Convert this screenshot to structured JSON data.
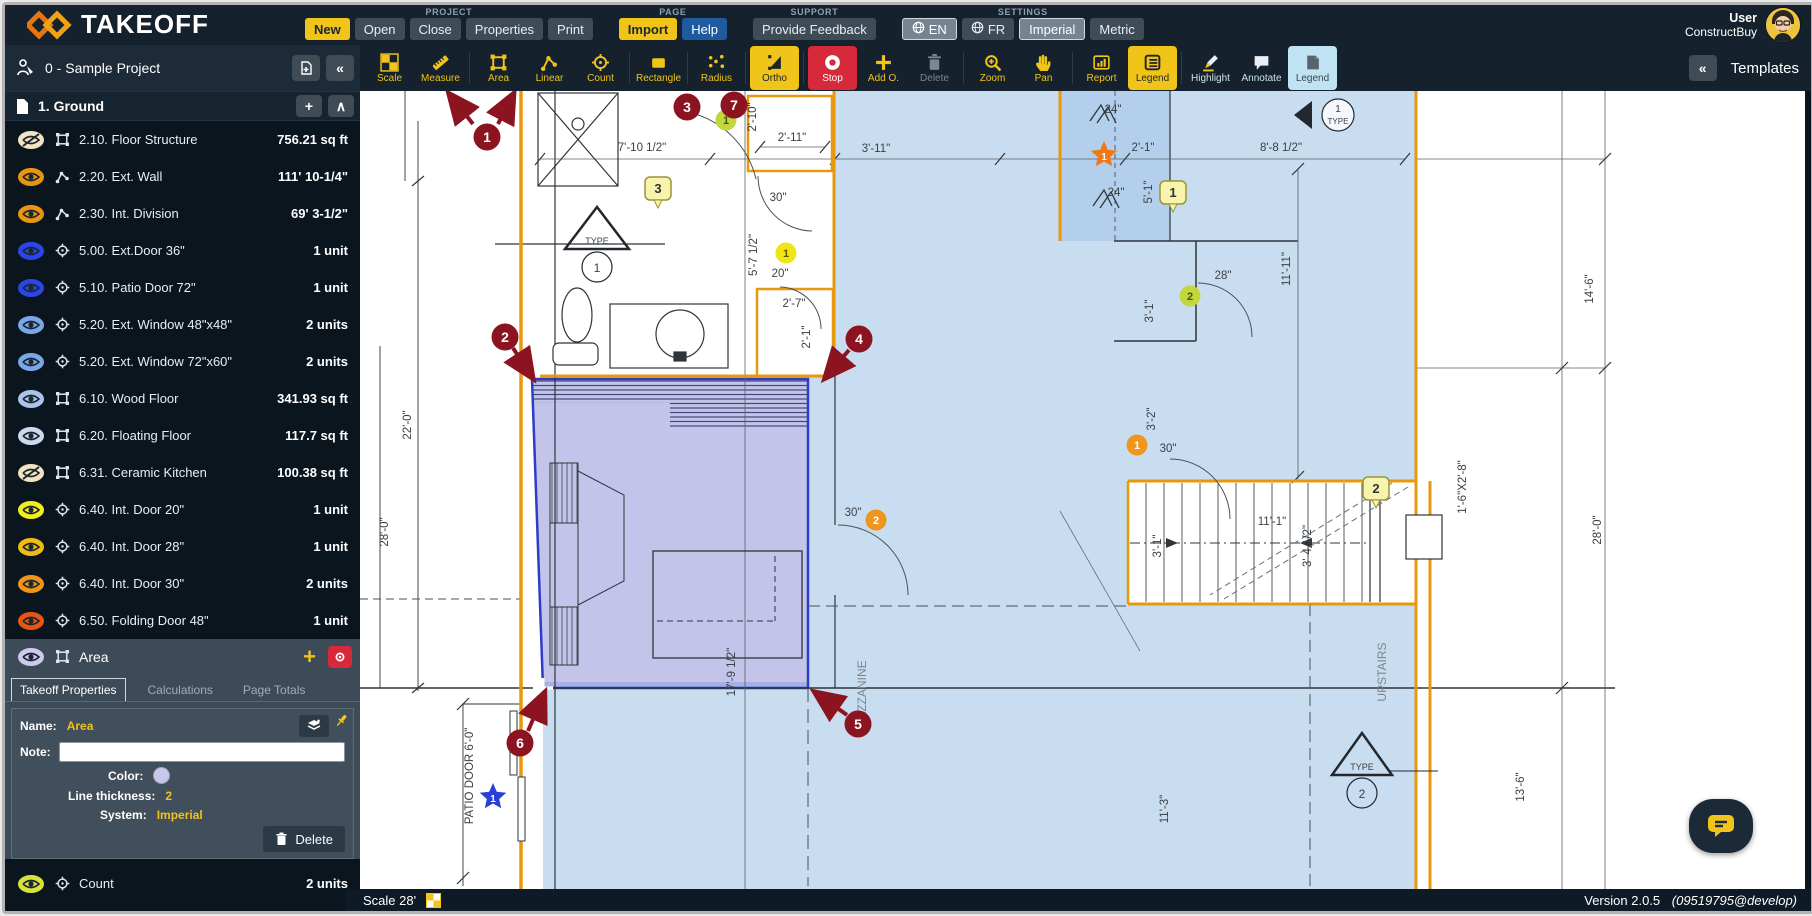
{
  "header": {
    "logo_text": "TAKEOFF",
    "user": {
      "line1": "User",
      "line2": "ConstructBuy"
    },
    "menu_groups": [
      {
        "label": "PROJECT",
        "buttons": [
          {
            "label": "New",
            "style": "yellow"
          },
          {
            "label": "Open"
          },
          {
            "label": "Close"
          },
          {
            "label": "Properties"
          },
          {
            "label": "Print"
          }
        ]
      },
      {
        "label": "PAGE",
        "buttons": [
          {
            "label": "Import",
            "style": "yellow"
          },
          {
            "label": "Help",
            "style": "blue"
          }
        ]
      },
      {
        "label": "SUPPORT",
        "buttons": [
          {
            "label": "Provide Feedback"
          }
        ]
      },
      {
        "label": "SETTINGS",
        "buttons": [
          {
            "label": "EN",
            "style": "selected",
            "icon": "globe"
          },
          {
            "label": "FR",
            "icon": "globe"
          },
          {
            "label": "Imperial",
            "style": "selected"
          },
          {
            "label": "Metric"
          }
        ]
      }
    ]
  },
  "project_bar": {
    "title": "0 - Sample Project"
  },
  "toolbar": {
    "templates_label": "Templates",
    "tools": [
      {
        "label": "Scale",
        "icon": "scale"
      },
      {
        "label": "Measure",
        "icon": "measure"
      },
      {
        "label": "Area",
        "icon": "area",
        "sep": true
      },
      {
        "label": "Linear",
        "icon": "linear"
      },
      {
        "label": "Count",
        "icon": "count"
      },
      {
        "label": "Rectangle",
        "icon": "rectangle",
        "sep": true
      },
      {
        "label": "Radius",
        "icon": "radius",
        "sep": true
      },
      {
        "label": "Ortho",
        "icon": "ortho",
        "state": "active-yellow",
        "sep": true
      },
      {
        "label": "Stop",
        "icon": "stop",
        "state": "active-red",
        "sep": true
      },
      {
        "label": "Add O.",
        "icon": "plus"
      },
      {
        "label": "Delete",
        "icon": "trash",
        "state": "disabled"
      },
      {
        "label": "Zoom",
        "icon": "zoom",
        "sep": true
      },
      {
        "label": "Pan",
        "icon": "pan"
      },
      {
        "label": "Report",
        "icon": "report",
        "sep": true
      },
      {
        "label": "Legend",
        "icon": "legendlist",
        "state": "active-yellow"
      },
      {
        "label": "Highlight",
        "icon": "highlight",
        "state": "light",
        "sep": true
      },
      {
        "label": "Annotate",
        "icon": "annotate",
        "state": "light"
      },
      {
        "label": "Legend",
        "icon": "legendnote",
        "state": "active-blue"
      }
    ]
  },
  "sidebar": {
    "group": {
      "title": "1. Ground"
    },
    "items": [
      {
        "label": "2.10. Floor Structure",
        "value": "756.21 sq ft",
        "type": "area",
        "eye": "#f2e4c0",
        "hidden": true
      },
      {
        "label": "2.20. Ext. Wall",
        "value": "111' 10-1/4\"",
        "type": "linear",
        "eye": "#e8960f"
      },
      {
        "label": "2.30. Int. Division",
        "value": "69' 3-1/2\"",
        "type": "linear",
        "eye": "#e8960f"
      },
      {
        "label": "5.00. Ext.Door 36\"",
        "value": "1 unit",
        "type": "count",
        "eye": "#2a46e8"
      },
      {
        "label": "5.10. Patio Door 72\"",
        "value": "1 unit",
        "type": "count",
        "eye": "#2a46e8"
      },
      {
        "label": "5.20. Ext. Window 48\"x48\"",
        "value": "2 units",
        "type": "count",
        "eye": "#7aa7e8"
      },
      {
        "label": "5.20. Ext. Window 72\"x60\"",
        "value": "2 units",
        "type": "count",
        "eye": "#7aa7e8"
      },
      {
        "label": "6.10. Wood Floor",
        "value": "341.93 sq ft",
        "type": "area",
        "eye": "#aac4ea"
      },
      {
        "label": "6.20. Floating Floor",
        "value": "117.7 sq ft",
        "type": "area",
        "eye": "#ccd9ef"
      },
      {
        "label": "6.31. Ceramic Kitchen",
        "value": "100.38 sq ft",
        "type": "area",
        "eye": "#f2e4c0",
        "hidden": true
      },
      {
        "label": "6.40. Int. Door 20\"",
        "value": "1 unit",
        "type": "count",
        "eye": "#f2ee1f"
      },
      {
        "label": "6.40. Int. Door 28\"",
        "value": "1 unit",
        "type": "count",
        "eye": "#eebc13"
      },
      {
        "label": "6.40. Int. Door 30\"",
        "value": "2 units",
        "type": "count",
        "eye": "#ee9418"
      },
      {
        "label": "6.50. Folding Door 48\"",
        "value": "1 unit",
        "type": "count",
        "eye": "#e85513"
      }
    ],
    "selected": {
      "name": "Area",
      "eye": "#cfc8f0",
      "tabs": [
        "Takeoff Properties",
        "Calculations",
        "Page Totals"
      ],
      "fields": {
        "name_label": "Name:",
        "name_value": "Area",
        "note_label": "Note:",
        "note_value": "",
        "color_label": "Color:",
        "color_value": "#c9c6ee",
        "thickness_label": "Line thickness:",
        "thickness_value": "2",
        "system_label": "System:",
        "system_value": "Imperial"
      },
      "delete_label": "Delete"
    },
    "bottom_items": [
      {
        "label": "Count",
        "value": "2 units",
        "type": "count",
        "eye": "#d6e33c"
      },
      {
        "label": "Longueur",
        "value": "16' 7\"",
        "type": "linear",
        "eye": "#9aa39b"
      }
    ]
  },
  "statusbar": {
    "scale_label": "Scale 28'",
    "version": "Version 2.0.5",
    "build": "(09519795@develop)"
  },
  "canvas": {
    "labels": [
      {
        "t": "7'-10 1/2\"",
        "x": 282,
        "y": 60
      },
      {
        "t": "2'-11\"",
        "x": 432,
        "y": 50
      },
      {
        "t": "3'-11\"",
        "x": 516,
        "y": 61
      },
      {
        "t": "2'-1\"",
        "x": 783,
        "y": 60
      },
      {
        "t": "8'-8 1/2\"",
        "x": 921,
        "y": 60
      },
      {
        "t": "24\"",
        "x": 753,
        "y": 22
      },
      {
        "t": "24\"",
        "x": 756,
        "y": 105
      },
      {
        "t": "2'-10\"",
        "x": 396,
        "y": 26,
        "r": 1
      },
      {
        "t": "5'-1\"",
        "x": 792,
        "y": 101,
        "r": 1
      },
      {
        "t": "30\"",
        "x": 418,
        "y": 110
      },
      {
        "t": "20\"",
        "x": 420,
        "y": 186
      },
      {
        "t": "5'-7 1/2\"",
        "x": 397,
        "y": 164,
        "r": 1
      },
      {
        "t": "2'-7\"",
        "x": 434,
        "y": 216
      },
      {
        "t": "2'-1\"",
        "x": 450,
        "y": 246,
        "r": 1
      },
      {
        "t": "28\"",
        "x": 863,
        "y": 188
      },
      {
        "t": "11'-11\"",
        "x": 930,
        "y": 178,
        "r": 1
      },
      {
        "t": "3'-1\"",
        "x": 793,
        "y": 220,
        "r": 1
      },
      {
        "t": "3'-2\"",
        "x": 795,
        "y": 328,
        "r": 1
      },
      {
        "t": "30\"",
        "x": 808,
        "y": 361
      },
      {
        "t": "30\"",
        "x": 493,
        "y": 425
      },
      {
        "t": "11'-1\"",
        "x": 912,
        "y": 434
      },
      {
        "t": "3'-1\"",
        "x": 801,
        "y": 455,
        "r": 1
      },
      {
        "t": "3'-4 1/2\"",
        "x": 951,
        "y": 455,
        "r": 1
      },
      {
        "t": "22'-0\"",
        "x": 51,
        "y": 334,
        "r": 1
      },
      {
        "t": "28'-0\"",
        "x": 28,
        "y": 441,
        "r": 1
      },
      {
        "t": "17'-9 1/2\"",
        "x": 375,
        "y": 581,
        "r": 1
      },
      {
        "t": "MEZZANINE",
        "x": 506,
        "y": 604,
        "r": 1,
        "c": "#7e868d",
        "s": 12
      },
      {
        "t": "UPSTAIRS",
        "x": 1026,
        "y": 581,
        "r": 1,
        "c": "#7e868d",
        "s": 12
      },
      {
        "t": "11'-3\"",
        "x": 808,
        "y": 718,
        "r": 1
      },
      {
        "t": "13'-6\"",
        "x": 1164,
        "y": 696,
        "r": 1
      },
      {
        "t": "28'-0\"",
        "x": 1241,
        "y": 439,
        "r": 1
      },
      {
        "t": "14'-6\"",
        "x": 1233,
        "y": 198,
        "r": 1
      },
      {
        "t": "1'-6\"X2'-8\"",
        "x": 1106,
        "y": 396,
        "r": 1
      },
      {
        "t": "PATIO DOOR 6'-0\"",
        "x": 113,
        "y": 685,
        "r": 1
      },
      {
        "t": "TYPE",
        "x": 237,
        "y": 153,
        "s": 9
      },
      {
        "t": "1",
        "x": 237,
        "y": 181,
        "s": 12
      },
      {
        "t": "TYPE",
        "x": 1002,
        "y": 679,
        "s": 9
      },
      {
        "t": "2",
        "x": 1002,
        "y": 707,
        "s": 12
      },
      {
        "t": "1",
        "x": 978,
        "y": 21,
        "s": 10
      },
      {
        "t": "TYPE",
        "x": 978,
        "y": 33,
        "s": 8
      }
    ],
    "markers": [
      {
        "n": "1",
        "x": 127,
        "y": 46,
        "arrows": [
          [
            113,
            33,
            90,
            4
          ],
          [
            138,
            33,
            153,
            4
          ]
        ]
      },
      {
        "n": "2",
        "x": 145,
        "y": 246,
        "arrows": [
          [
            153,
            257,
            172,
            286
          ]
        ]
      },
      {
        "n": "3",
        "x": 327,
        "y": 16,
        "arrows": []
      },
      {
        "n": "4",
        "x": 499,
        "y": 248,
        "arrows": [
          [
            489,
            259,
            466,
            286
          ]
        ]
      },
      {
        "n": "5",
        "x": 498,
        "y": 633,
        "arrows": [
          [
            487,
            624,
            456,
            602
          ]
        ]
      },
      {
        "n": "6",
        "x": 160,
        "y": 652,
        "arrows": [
          [
            168,
            640,
            184,
            603
          ]
        ]
      },
      {
        "n": "7",
        "x": 374,
        "y": 14,
        "arrows": []
      }
    ],
    "notes": [
      {
        "n": "3",
        "x": 298,
        "y": 98
      },
      {
        "n": "1",
        "x": 813,
        "y": 102
      },
      {
        "n": "2",
        "x": 1016,
        "y": 398
      }
    ],
    "badges": [
      {
        "n": "1",
        "x": 426,
        "y": 162,
        "bg": "#f0e616",
        "fg": "#5f5606"
      },
      {
        "n": "2",
        "x": 830,
        "y": 205,
        "bg": "#c3d63c",
        "fg": "#4a5206"
      },
      {
        "n": "1",
        "x": 366,
        "y": 29,
        "bg": "#c3d63c",
        "fg": "#4a5206"
      },
      {
        "n": "1",
        "x": 777,
        "y": 354,
        "bg": "#f0961e",
        "fg": "#ffffff"
      },
      {
        "n": "2",
        "x": 516,
        "y": 429,
        "bg": "#f0961e",
        "fg": "#ffffff"
      }
    ],
    "stars": [
      {
        "n": "1",
        "x": 133,
        "y": 706,
        "bg": "#2a3fd4"
      },
      {
        "n": "1",
        "x": 744,
        "y": 64,
        "bg": "#f07816"
      }
    ]
  }
}
